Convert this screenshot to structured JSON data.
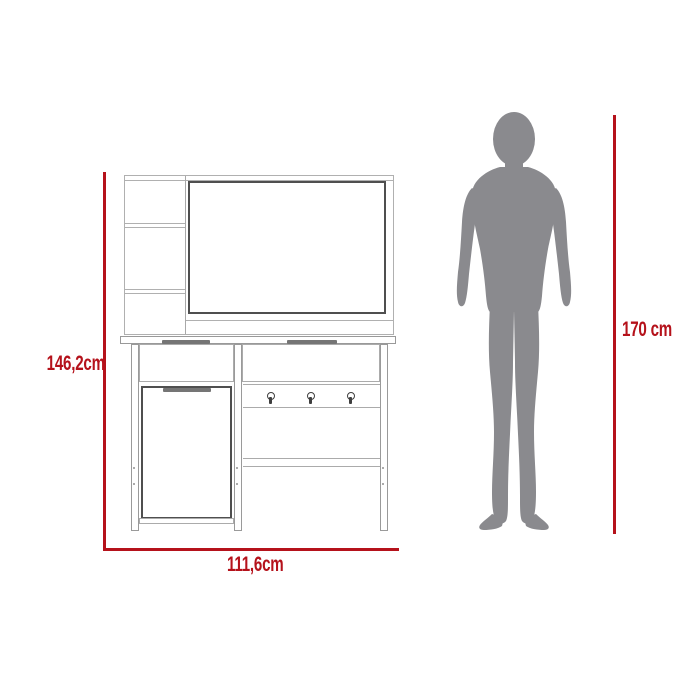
{
  "diagram": {
    "type": "furniture-dimension-diagram",
    "labels": {
      "height": "146,2cm",
      "width": "111,6cm",
      "person_height": "170 cm"
    },
    "colors": {
      "dimension_red": "#b5121b",
      "silhouette_gray": "#8a8a8e",
      "outline_light": "#b0b0b0",
      "outline_dark": "#4f4f4f",
      "handle_gray": "#757575"
    },
    "furniture": {
      "hook_count": 3,
      "shelf_compartments": 3,
      "drawer_count": 2,
      "door_count": 1
    }
  }
}
